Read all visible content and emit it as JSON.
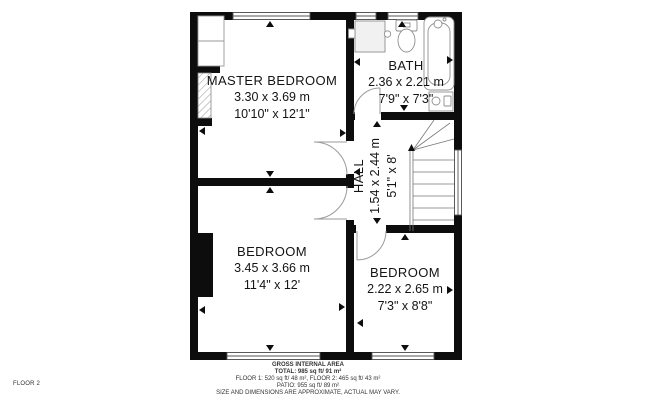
{
  "rooms": {
    "master_bedroom": {
      "name": "MASTER BEDROOM",
      "metric": "3.30 x 3.69 m",
      "imperial": "10'10\" x 12'1\""
    },
    "bath": {
      "name": "BATH",
      "metric": "2.36 x 2.21 m",
      "imperial": "7'9\" x 7'3\""
    },
    "hall": {
      "name": "HALL",
      "metric": "1.54 x 2.44 m",
      "imperial": "5'1\" x 8'"
    },
    "bedroom_1": {
      "name": "BEDROOM",
      "metric": "3.45 x 3.66 m",
      "imperial": "11'4\" x 12'"
    },
    "bedroom_2": {
      "name": "BEDROOM",
      "metric": "2.22 x 2.65 m",
      "imperial": "7'3\" x 8'8\""
    }
  },
  "footer": {
    "floor_label": "FLOOR 2",
    "area_title": "GROSS INTERNAL AREA",
    "total": "TOTAL: 985 sq ft/ 91 m²",
    "floors": "FLOOR 1: 520 sq ft/ 48 m², FLOOR 2: 465 sq ft/ 43 m²",
    "patio": "PATIO: 955 sq ft/ 89 m²",
    "disclaimer": "SIZE AND DIMENSIONS ARE APPROXIMATE, ACTUAL MAY VARY."
  },
  "colors": {
    "wall": "#0d0d0d",
    "fixture_outline": "#8f8f8f",
    "door_arc": "#9a9a9a",
    "text": "#141414"
  }
}
